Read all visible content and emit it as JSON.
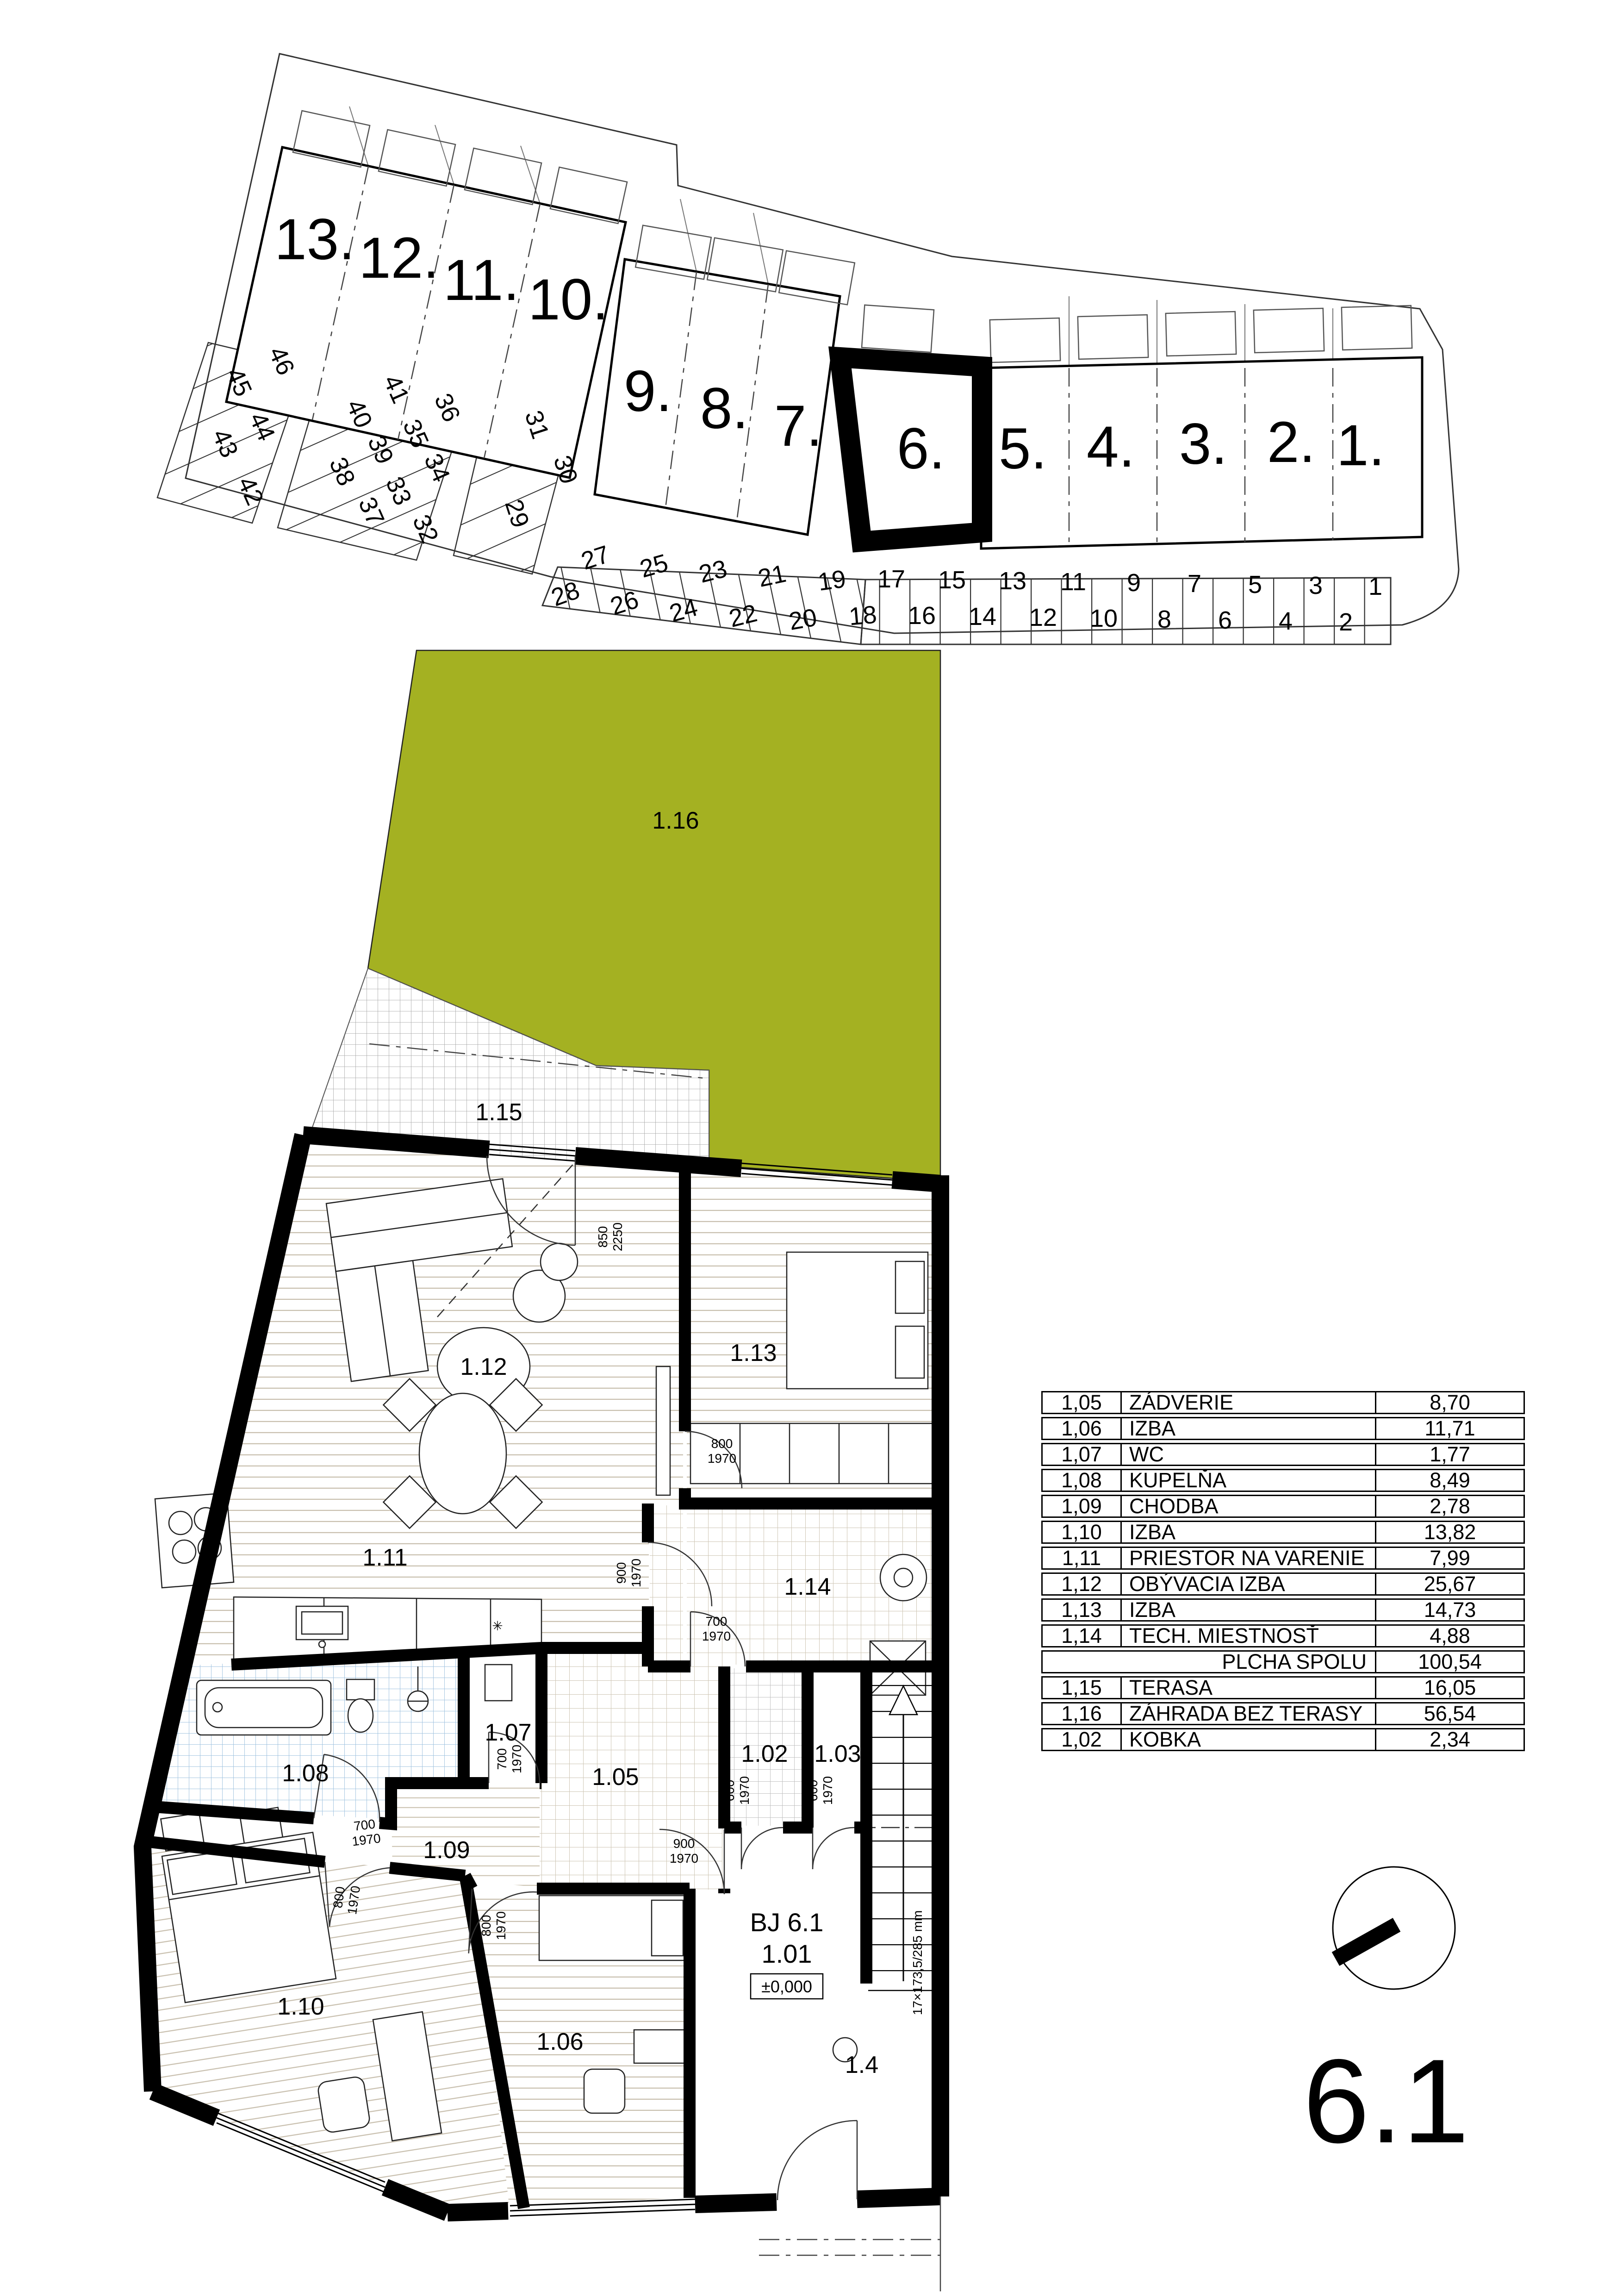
{
  "colors": {
    "garden": "#a4b122",
    "wall": "#000000",
    "plank_line": "#c8bfae",
    "tan_line": "#cfc7b6",
    "blue_line": "#9cc0de",
    "terrace_line": "#a9a9a9"
  },
  "site": {
    "houses": [
      "13.",
      "12.",
      "11.",
      "10.",
      "9.",
      "8.",
      "7.",
      "6.",
      "5.",
      "4.",
      "3.",
      "2.",
      "1."
    ],
    "stalls": [
      "1",
      "2",
      "3",
      "4",
      "5",
      "6",
      "7",
      "8",
      "9",
      "10",
      "11",
      "12",
      "13",
      "14",
      "15",
      "16",
      "17",
      "18",
      "19",
      "20",
      "21",
      "22",
      "23",
      "24",
      "25",
      "26",
      "27",
      "28"
    ],
    "field": [
      "29",
      "30",
      "31",
      "32",
      "33",
      "34",
      "35",
      "36",
      "37",
      "38",
      "39",
      "40",
      "41",
      "42",
      "43",
      "44",
      "45",
      "46"
    ]
  },
  "plan": {
    "rooms": {
      "r101": "1.01",
      "r102": "1.02",
      "r103": "1.03",
      "r104": "1.4",
      "r105": "1.05",
      "r106": "1.06",
      "r107": "1.07",
      "r108": "1.08",
      "r109": "1.09",
      "r110": "1.10",
      "r111": "1.11",
      "r112": "1.12",
      "r113": "1.13",
      "r114": "1.14",
      "r115": "1.15",
      "r116": "1.16"
    },
    "unit": "BJ 6.1",
    "level": "±0,000",
    "stair_note": "17×173,5/285 mm",
    "dims": {
      "v600": "600",
      "v700": "700",
      "v800": "800",
      "v850": "850",
      "v900": "900",
      "v1970": "1970",
      "v2250": "2250"
    }
  },
  "table": {
    "rows": [
      {
        "id": "1,05",
        "name": "ZÁDVERIE",
        "area": "8,70"
      },
      {
        "id": "1,06",
        "name": "IZBA",
        "area": "11,71"
      },
      {
        "id": "1,07",
        "name": "WC",
        "area": "1,77"
      },
      {
        "id": "1,08",
        "name": "KUPELŇA",
        "area": "8,49"
      },
      {
        "id": "1,09",
        "name": "CHODBA",
        "area": "2,78"
      },
      {
        "id": "1,10",
        "name": "IZBA",
        "area": "13,82"
      },
      {
        "id": "1,11",
        "name": "PRIESTOR NA VARENIE",
        "area": "7,99"
      },
      {
        "id": "1,12",
        "name": "OBÝVACIA IZBA",
        "area": "25,67"
      },
      {
        "id": "1,13",
        "name": "IZBA",
        "area": "14,73"
      },
      {
        "id": "1,14",
        "name": "TECH. MIESTNOSŤ",
        "area": "4,88"
      },
      {
        "id": "",
        "name": "PLCHA SPOLU",
        "area": "100,54"
      },
      {
        "id": "1,15",
        "name": "TERASA",
        "area": "16,05"
      },
      {
        "id": "1,16",
        "name": "ZÁHRADA BEZ TERASY",
        "area": "56,54"
      },
      {
        "id": "1,02",
        "name": "KOBKA",
        "area": "2,34"
      }
    ]
  },
  "compass": {
    "label": "6.1"
  }
}
